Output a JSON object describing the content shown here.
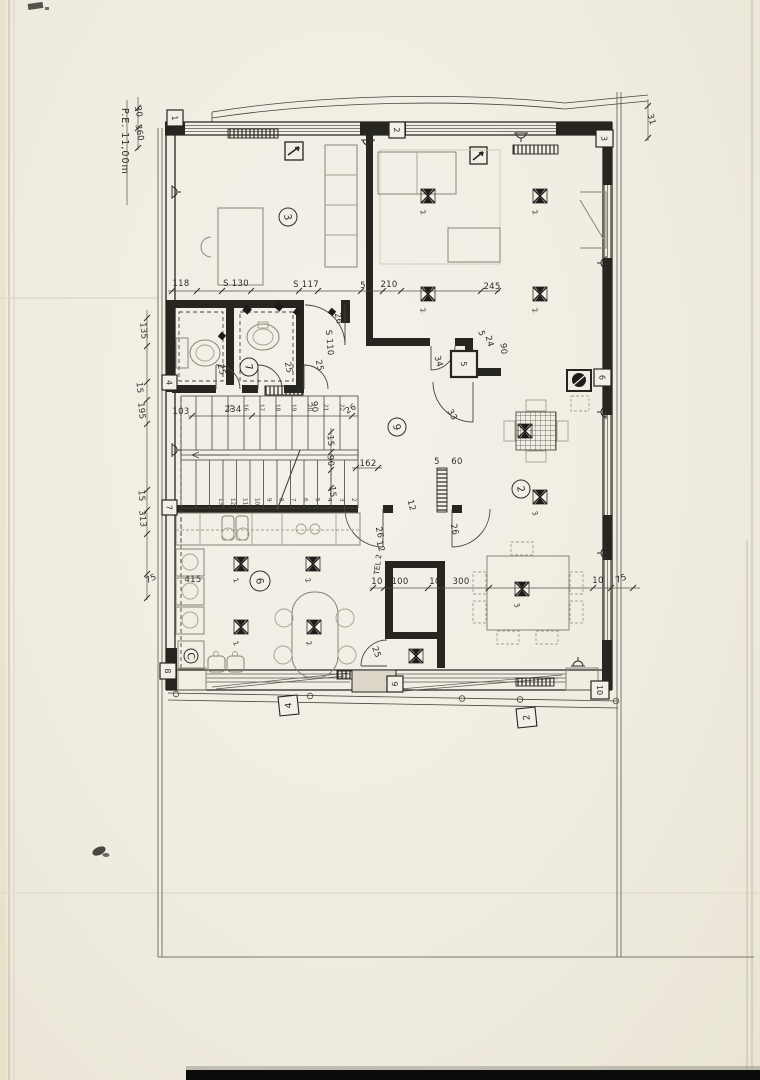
{
  "drawing": {
    "site_label": "P.E. 11,00m",
    "tel_label": "TEL 2",
    "rooms": [
      {
        "label": "3",
        "cx": 288,
        "cy": 217,
        "r": 9
      },
      {
        "label": "7",
        "cx": 249,
        "cy": 367,
        "r": 9
      },
      {
        "label": "9",
        "cx": 397,
        "cy": 427,
        "r": 9
      },
      {
        "label": "2",
        "cx": 521,
        "cy": 489,
        "r": 9
      },
      {
        "label": "6",
        "cx": 260,
        "cy": 581,
        "r": 10
      },
      {
        "label": "C",
        "cx": 191,
        "cy": 656,
        "r": 7
      }
    ],
    "axis_markers": [
      {
        "label": "1",
        "x": 167,
        "y": 110,
        "s": 16
      },
      {
        "label": "2",
        "x": 389,
        "y": 122,
        "s": 16
      },
      {
        "label": "3",
        "x": 596,
        "y": 130,
        "s": 17
      },
      {
        "label": "4",
        "x": 162,
        "y": 375,
        "s": 15
      },
      {
        "label": "5",
        "x": 451,
        "y": 351,
        "s": 26
      },
      {
        "label": "6",
        "x": 594,
        "y": 369,
        "s": 17
      },
      {
        "label": "7",
        "x": 162,
        "y": 500,
        "s": 15
      },
      {
        "label": "8",
        "x": 160,
        "y": 663,
        "s": 16
      },
      {
        "label": "9",
        "x": 387,
        "y": 676,
        "s": 16
      },
      {
        "label": "10",
        "x": 591,
        "y": 681,
        "s": 18
      }
    ],
    "ref_markers": [
      {
        "label": "4",
        "x": 279,
        "y": 696,
        "s": 19
      },
      {
        "label": "2",
        "x": 517,
        "y": 708,
        "s": 19
      }
    ],
    "dimensions": [
      {
        "t": "30",
        "x": 136,
        "y": 112,
        "r": 80
      },
      {
        "t": "360",
        "x": 137,
        "y": 133,
        "r": 80
      },
      {
        "t": "31",
        "x": 649,
        "y": 120,
        "r": 75
      },
      {
        "t": "118",
        "x": 181,
        "y": 286,
        "r": 0
      },
      {
        "t": "S  130",
        "x": 236,
        "y": 286,
        "r": 0
      },
      {
        "t": "S  117",
        "x": 306,
        "y": 287,
        "r": 0
      },
      {
        "t": "5",
        "x": 363,
        "y": 288,
        "r": 0
      },
      {
        "t": "210",
        "x": 389,
        "y": 287,
        "r": 0
      },
      {
        "t": "245",
        "x": 492,
        "y": 289,
        "r": 0
      },
      {
        "t": "135",
        "x": 141,
        "y": 331,
        "r": 85
      },
      {
        "t": "15",
        "x": 137,
        "y": 388,
        "r": 85
      },
      {
        "t": "195",
        "x": 139,
        "y": 411,
        "r": 85
      },
      {
        "t": "15",
        "x": 139,
        "y": 496,
        "r": 85
      },
      {
        "t": "313",
        "x": 140,
        "y": 519,
        "r": 85
      },
      {
        "t": "75",
        "x": 152,
        "y": 581,
        "r": -25
      },
      {
        "t": "103",
        "x": 181,
        "y": 414,
        "r": 0
      },
      {
        "t": "234",
        "x": 233,
        "y": 412,
        "r": 0
      },
      {
        "t": "26",
        "x": 352,
        "y": 411,
        "r": -30
      },
      {
        "t": "90",
        "x": 312,
        "y": 407,
        "r": 85
      },
      {
        "t": "15",
        "x": 328,
        "y": 441,
        "r": 85
      },
      {
        "t": "90",
        "x": 328,
        "y": 461,
        "r": 85
      },
      {
        "t": "162",
        "x": 368,
        "y": 466,
        "r": 0
      },
      {
        "t": "15",
        "x": 330,
        "y": 492,
        "r": 85
      },
      {
        "t": "26",
        "x": 336,
        "y": 319,
        "r": 78
      },
      {
        "t": "S 110",
        "x": 327,
        "y": 343,
        "r": 85
      },
      {
        "t": "25",
        "x": 219,
        "y": 370,
        "r": 78
      },
      {
        "t": "25",
        "x": 286,
        "y": 368,
        "r": 78
      },
      {
        "t": "25",
        "x": 317,
        "y": 366,
        "r": 78
      },
      {
        "t": "34",
        "x": 436,
        "y": 362,
        "r": 75
      },
      {
        "t": "5",
        "x": 479,
        "y": 334,
        "r": 75
      },
      {
        "t": "24",
        "x": 487,
        "y": 342,
        "r": 75
      },
      {
        "t": "90",
        "x": 501,
        "y": 349,
        "r": 85
      },
      {
        "t": "33",
        "x": 450,
        "y": 416,
        "r": 60
      },
      {
        "t": "5",
        "x": 437,
        "y": 464,
        "r": 0
      },
      {
        "t": "60",
        "x": 457,
        "y": 464,
        "r": 0
      },
      {
        "t": "12",
        "x": 409,
        "y": 506,
        "r": 75
      },
      {
        "t": "12",
        "x": 378,
        "y": 547,
        "r": 75
      },
      {
        "t": "26",
        "x": 377,
        "y": 533,
        "r": 78
      },
      {
        "t": "26",
        "x": 452,
        "y": 530,
        "r": 78
      },
      {
        "t": "415",
        "x": 193,
        "y": 582,
        "r": 0
      },
      {
        "t": "10",
        "x": 377,
        "y": 584,
        "r": 0
      },
      {
        "t": "100",
        "x": 400,
        "y": 584,
        "r": 0
      },
      {
        "t": "10",
        "x": 435,
        "y": 584,
        "r": 0
      },
      {
        "t": "300",
        "x": 461,
        "y": 584,
        "r": 0
      },
      {
        "t": "10",
        "x": 598,
        "y": 583,
        "r": 0
      },
      {
        "t": "75",
        "x": 622,
        "y": 581,
        "r": -20
      },
      {
        "t": "25",
        "x": 374,
        "y": 653,
        "r": 70
      }
    ],
    "stairs": {
      "top_numbers": [
        "15",
        "16",
        "17",
        "18",
        "19",
        "20",
        "21",
        "22"
      ],
      "top_x0": 228,
      "top_dx": 16,
      "top_y": 404,
      "bottom_numbers": [
        "13",
        "12",
        "11",
        "10",
        "9",
        "8",
        "7",
        "6",
        "5",
        "4",
        "3",
        "2"
      ],
      "bottom_x0": 219,
      "bottom_dx": 12.1,
      "bottom_y": 498
    },
    "lights": [
      {
        "x": 428,
        "y": 196,
        "label": "2"
      },
      {
        "x": 540,
        "y": 196,
        "label": "2"
      },
      {
        "x": 428,
        "y": 294,
        "label": "2"
      },
      {
        "x": 540,
        "y": 294,
        "label": "2"
      },
      {
        "x": 241,
        "y": 564,
        "label": "1"
      },
      {
        "x": 313,
        "y": 564,
        "label": "2"
      },
      {
        "x": 241,
        "y": 627,
        "label": "1"
      },
      {
        "x": 314,
        "y": 627,
        "label": "2"
      },
      {
        "x": 525,
        "y": 431,
        "label": ""
      },
      {
        "x": 540,
        "y": 497,
        "label": "3"
      },
      {
        "x": 522,
        "y": 589,
        "label": "3"
      },
      {
        "x": 416,
        "y": 656,
        "label": ""
      }
    ],
    "outlets": [
      {
        "x": 172,
        "y": 192,
        "r": 0
      },
      {
        "x": 172,
        "y": 450,
        "r": 0
      },
      {
        "x": 368,
        "y": 140,
        "r": 90
      },
      {
        "x": 521,
        "y": 133,
        "r": 90
      },
      {
        "x": 606,
        "y": 263,
        "r": 180
      },
      {
        "x": 606,
        "y": 412,
        "r": 180
      },
      {
        "x": 606,
        "y": 553,
        "r": 180
      },
      {
        "x": 578,
        "y": 666,
        "r": 270
      }
    ]
  }
}
